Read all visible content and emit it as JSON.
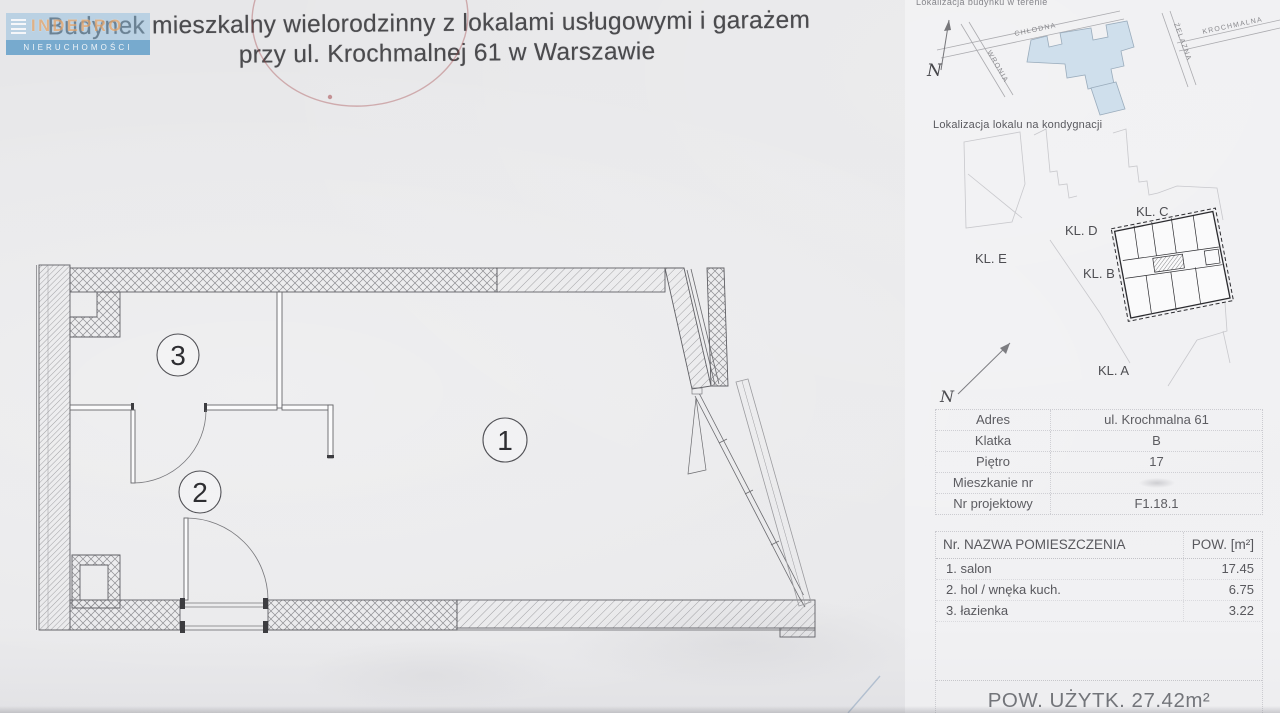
{
  "logo": {
    "name": "INDEPRO",
    "tagline": "NIERUCHOMOŚCI"
  },
  "title": {
    "line1": "Budynek mieszkalny wielorodzinny z lokalami usługowymi i garażem",
    "line2": "przy ul. Krochmalnej 61 w Warszawie"
  },
  "floor_plan": {
    "room_labels": {
      "salon": "1",
      "hol": "2",
      "lazienka": "3"
    }
  },
  "site_map": {
    "caption": "Lokalizacja budynku w terenie",
    "streets": {
      "chlodna": "CHŁODNA",
      "wronia": "WRONIA",
      "zelazna": "ŻELAZNA",
      "krochmalna": "KROCHMALNA"
    },
    "north": "N"
  },
  "floor_map": {
    "caption": "Lokalizacja lokalu na kondygnacji",
    "stairs": {
      "e": "KL. E",
      "d": "KL. D",
      "c": "KL. C",
      "b": "KL. B",
      "a": "KL. A"
    },
    "north": "N"
  },
  "details_table": {
    "rows": [
      {
        "label": "Adres",
        "value": "ul. Krochmalna 61"
      },
      {
        "label": "Klatka",
        "value": "B"
      },
      {
        "label": "Piętro",
        "value": "17"
      },
      {
        "label": "Mieszkanie nr",
        "value": ""
      },
      {
        "label": "Nr projektowy",
        "value": "F1.18.1"
      }
    ]
  },
  "rooms_table": {
    "header": {
      "col1": "Nr. NAZWA POMIESZCZENIA",
      "col2": "POW. [m²]"
    },
    "rows": [
      {
        "nr": "1.",
        "name": "salon",
        "area": "17.45"
      },
      {
        "nr": "2.",
        "name": "hol / wnęka kuch.",
        "area": "6.75"
      },
      {
        "nr": "3.",
        "name": "łazienka",
        "area": "3.22"
      }
    ]
  },
  "summary": {
    "total": "POW. UŻYTK. 27.42m²"
  },
  "colors": {
    "paper": "#e8e8ea",
    "ink": "#4b4b4e",
    "plan_line": "#606065",
    "hatch": "#8e8e92",
    "stamp_red": "#a03c40",
    "logo_blue": "#5899c7",
    "map_building": "#cfdfec"
  }
}
